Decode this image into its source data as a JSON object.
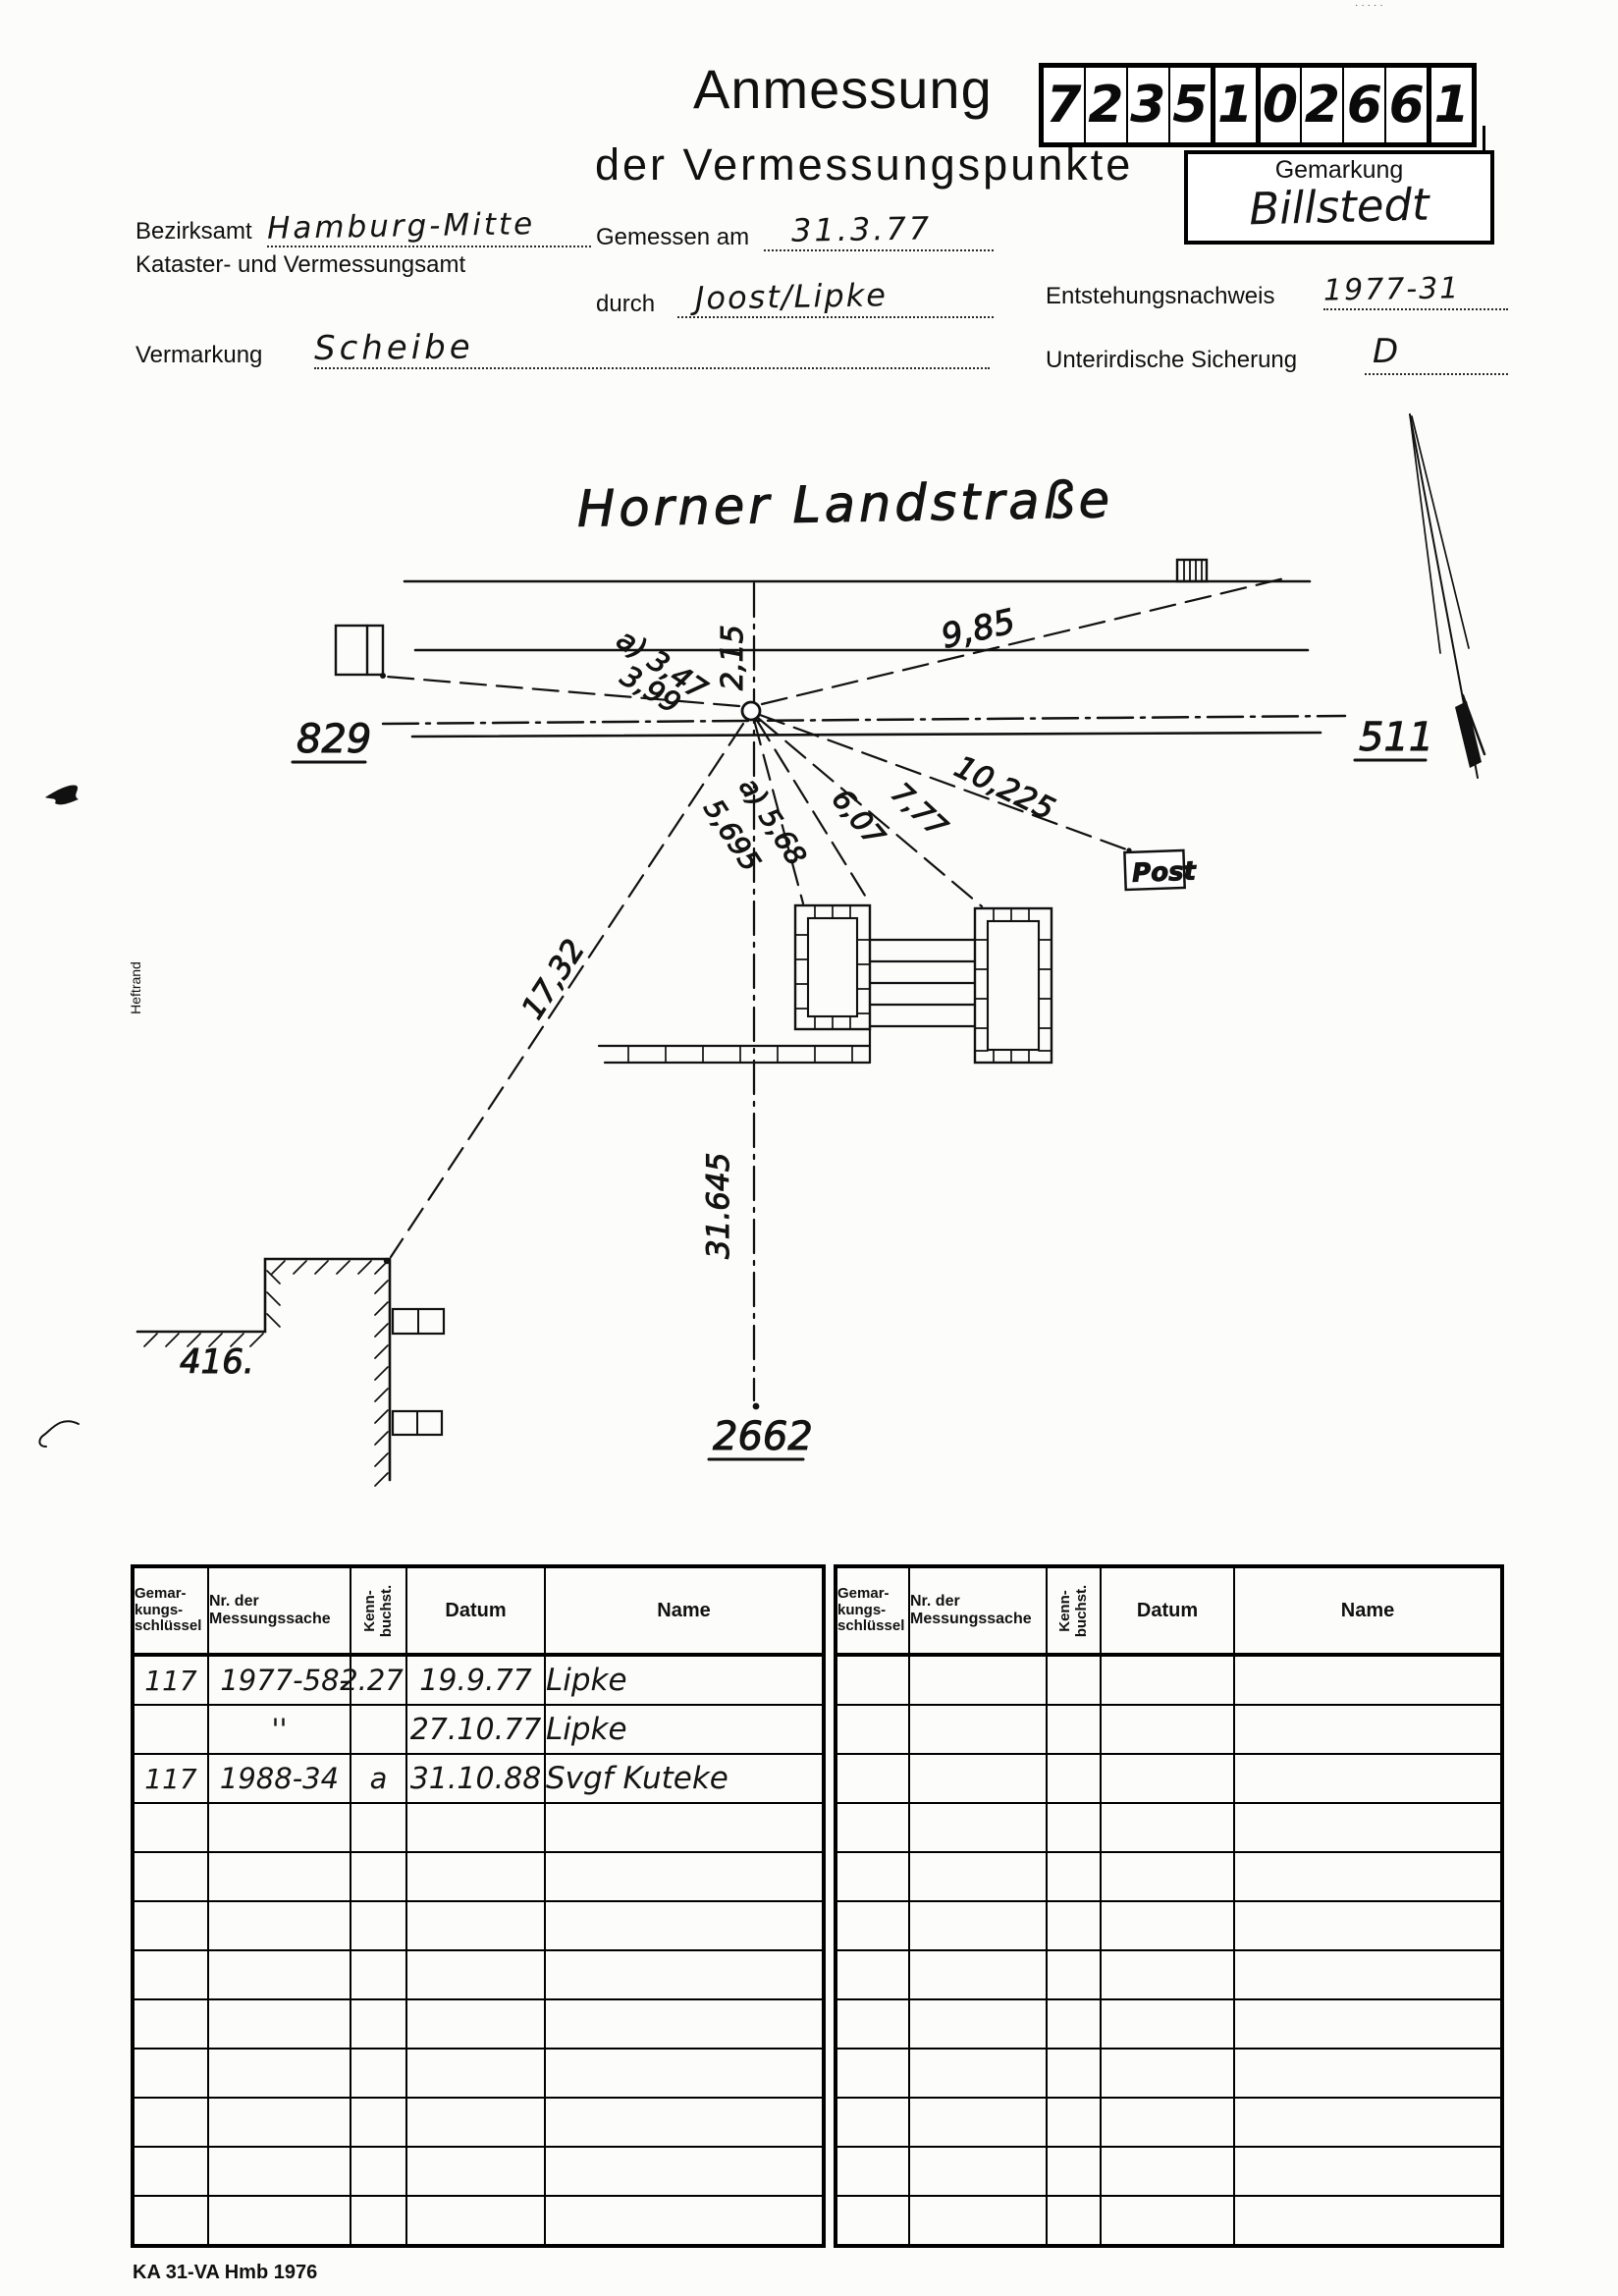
{
  "header": {
    "title": "Anmessung",
    "subtitle": "der Vermessungspunkte",
    "doc_number": "7235102661",
    "gemarkung_label": "Gemarkung",
    "gemarkung_value": "Billstedt"
  },
  "form": {
    "bezirksamt_label": "Bezirksamt",
    "bezirksamt_value": "Hamburg-Mitte",
    "amt_line": "Kataster- und Vermessungsamt",
    "gemessen_label": "Gemessen am",
    "gemessen_value": "31.3.77",
    "durch_label": "durch",
    "durch_value": "Joost/Lipke",
    "entstehung_label": "Entstehungsnachweis",
    "entstehung_value": "1977-31",
    "vermarkung_label": "Vermarkung",
    "vermarkung_value": "Scheibe",
    "sicherung_label": "Unterirdische Sicherung",
    "sicherung_value": "D"
  },
  "sketch": {
    "street_name": "Horner Landstraße",
    "label_829": "829",
    "label_511": "511",
    "label_2662": "2662",
    "label_416": "416.",
    "post_label": "Post",
    "heftrand_label": "Heftrand",
    "m_2_15": "2,15",
    "m_9_85": "9,85",
    "m_a_3_47": "a) 3,47",
    "m_3_99": "3,99",
    "m_10_225": "10,225",
    "m_7_77": "7,77",
    "m_6_07": "6,07",
    "m_a_5_68": "a) 5,68",
    "m_5_695": "5,695",
    "m_17_32": "17,32",
    "m_31_645": "31.645"
  },
  "table": {
    "header": {
      "c1_l1": "Gemar-",
      "c1_l2": "kungs-",
      "c1_l3": "schlüssel",
      "c2_l1": "Nr. der",
      "c2_l2": "Messungssache",
      "c3_l1": "Kenn-",
      "c3_l2": "buchst.",
      "c4": "Datum",
      "c5": "Name"
    },
    "rows": [
      [
        "117",
        "1977-58-",
        "2.27",
        "19.9.77",
        "Lipke"
      ],
      [
        "",
        "''",
        "",
        "27.10.77",
        "Lipke"
      ],
      [
        "117",
        "1988-34",
        "a",
        "31.10.88",
        "Svgf Kuteke"
      ],
      [
        "",
        "",
        "",
        "",
        ""
      ],
      [
        "",
        "",
        "",
        "",
        ""
      ],
      [
        "",
        "",
        "",
        "",
        ""
      ],
      [
        "",
        "",
        "",
        "",
        ""
      ],
      [
        "",
        "",
        "",
        "",
        ""
      ],
      [
        "",
        "",
        "",
        "",
        ""
      ],
      [
        "",
        "",
        "",
        "",
        ""
      ],
      [
        "",
        "",
        "",
        "",
        ""
      ],
      [
        "",
        "",
        "",
        "",
        ""
      ]
    ]
  },
  "footer": {
    "form_code": "KA 31-VA Hmb 1976"
  }
}
